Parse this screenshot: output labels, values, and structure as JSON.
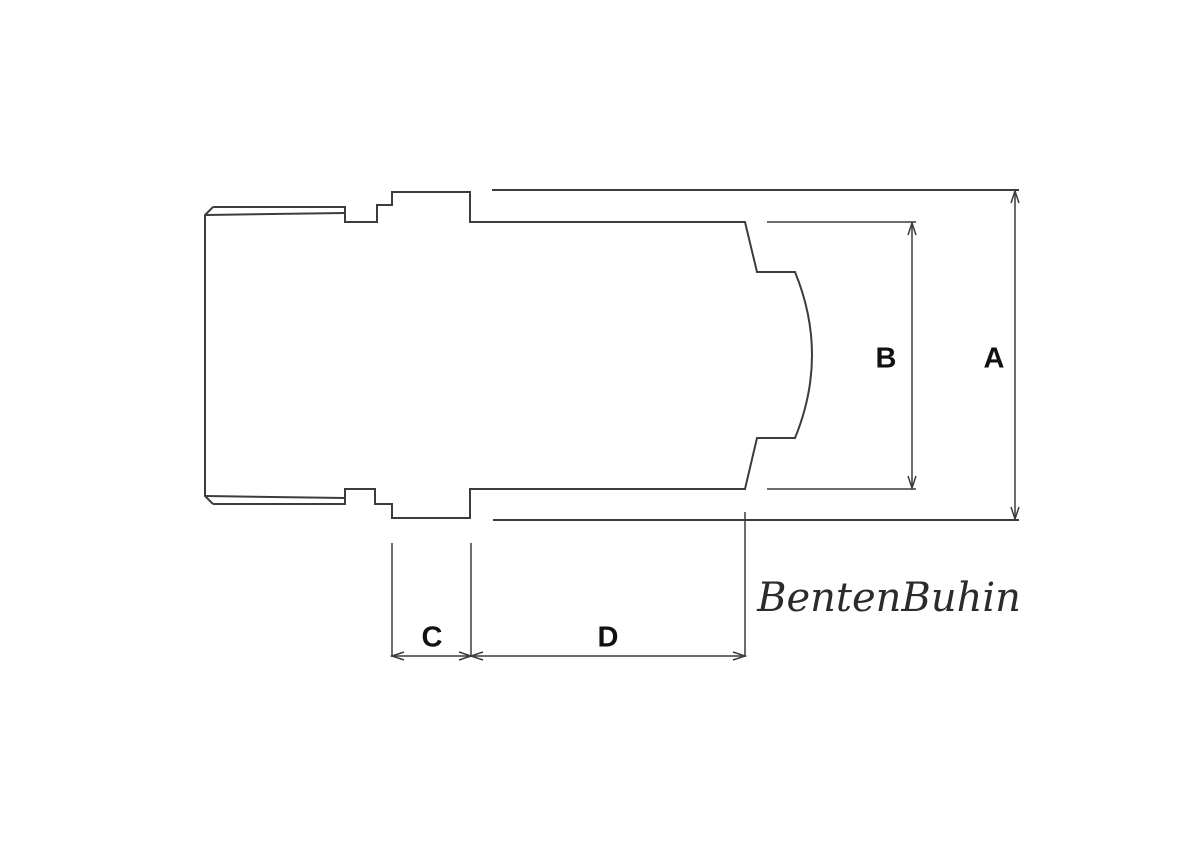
{
  "drawing": {
    "dimension_labels": {
      "a": "A",
      "b": "B",
      "c": "C",
      "d": "D"
    },
    "brand": "BentenBuhin"
  },
  "colors": {
    "line": "#3c3c3c",
    "label": "#111111",
    "brand_text": "#2b2b2b",
    "background": "#ffffff"
  }
}
